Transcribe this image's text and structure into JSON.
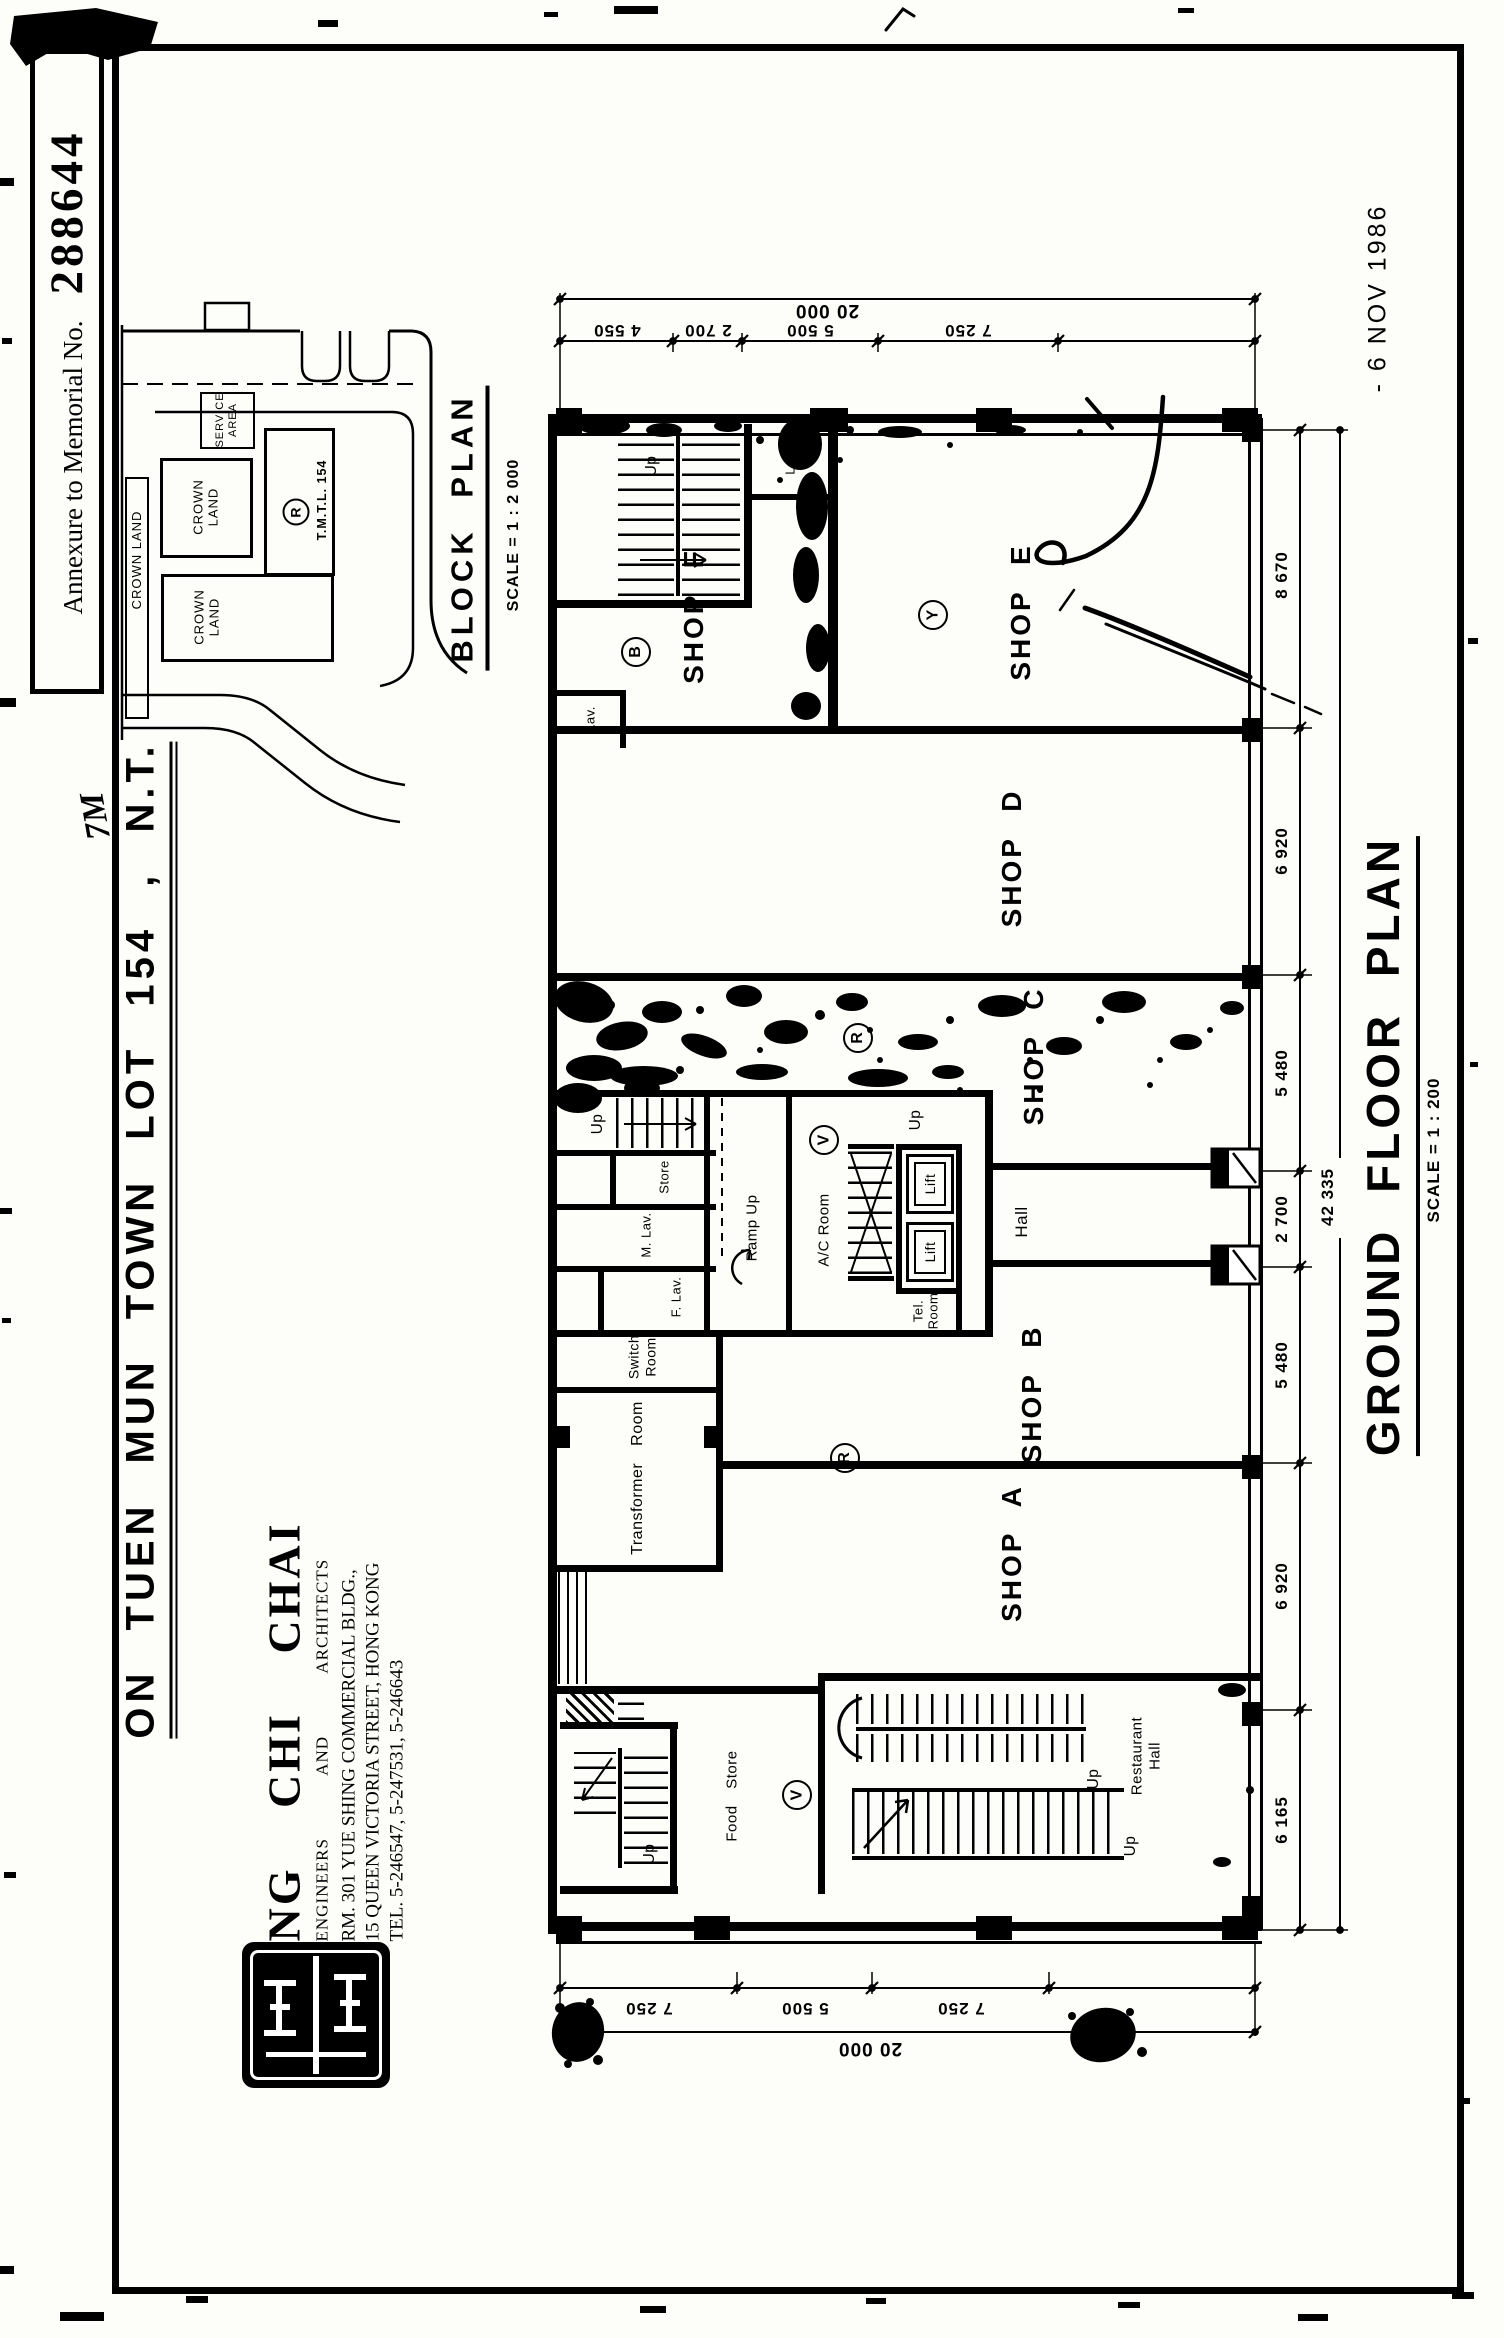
{
  "document": {
    "annexure_prefix": "Annexure to Memorial No.",
    "annexure_number": "288644",
    "date_stamp": "- 6 NOV 1986",
    "handwritten_mark": "7M",
    "lot_title": "ON TUEN MUN TOWN LOT 154 , N.T."
  },
  "architect": {
    "firm_name": "NG CHI CHAI",
    "firm_subtitle": "ENGINEERS AND ARCHITECTS",
    "address_line1": "RM. 301 YUE SHING COMMERCIAL BLDG.,",
    "address_line2": "15 QUEEN VICTORIA STREET, HONG KONG",
    "telephone": "TEL. 5-246547, 5-247531, 5-246643"
  },
  "block_plan": {
    "title": "BLOCK PLAN",
    "scale": "SCALE = 1 : 2 000",
    "crown_land_strip": "CROWN LAND",
    "crown_land_upper": {
      "l1": "CROWN",
      "l2": "LAND"
    },
    "crown_land_lower": {
      "l1": "CROWN",
      "l2": "LAND"
    },
    "service_area": {
      "l1": "SERVICE",
      "l2": "AREA"
    },
    "lot_mark": "R",
    "lot_ref": "T.M.T.L. 154"
  },
  "floor_plan": {
    "title": "GROUND FLOOR PLAN",
    "scale": "SCALE = 1 : 200",
    "shops": {
      "a": "SHOP A",
      "b": "SHOP B",
      "c": "SHOP C",
      "d": "SHOP D",
      "e": "SHOP E",
      "f": "SHOP F"
    },
    "rooms": {
      "hall": "Hall",
      "lift": "Lift",
      "tel_room": {
        "l1": "Tel.",
        "l2": "Room"
      },
      "ac_room": "A/C Room",
      "store": "Store",
      "m_lav": "M. Lav.",
      "f_lav": "F. Lav.",
      "lav": "Lav.",
      "ramp_up": "Ramp Up",
      "up": "Up",
      "switch_room": {
        "l1": "Switch",
        "l2": "Room"
      },
      "transformer_room": "Transformer Room",
      "food_store": "Food Store",
      "restaurant_hall": {
        "l1": "Restaurant",
        "l2": "Hall"
      }
    },
    "marks": {
      "b": "B",
      "y": "Y",
      "v": "V",
      "r": "R"
    },
    "dimensions": {
      "top_overall": "20 000",
      "top_segments": [
        "4 550",
        "2 700",
        "5 500",
        "7 250"
      ],
      "bottom_overall": "20 000",
      "bottom_segments": [
        "7 250",
        "5 500",
        "7 250"
      ],
      "side_overall": "42 335",
      "side_segments": [
        "8 670",
        "6 920",
        "5 480",
        "2 700",
        "5 480",
        "6 920",
        "6 165"
      ]
    }
  }
}
